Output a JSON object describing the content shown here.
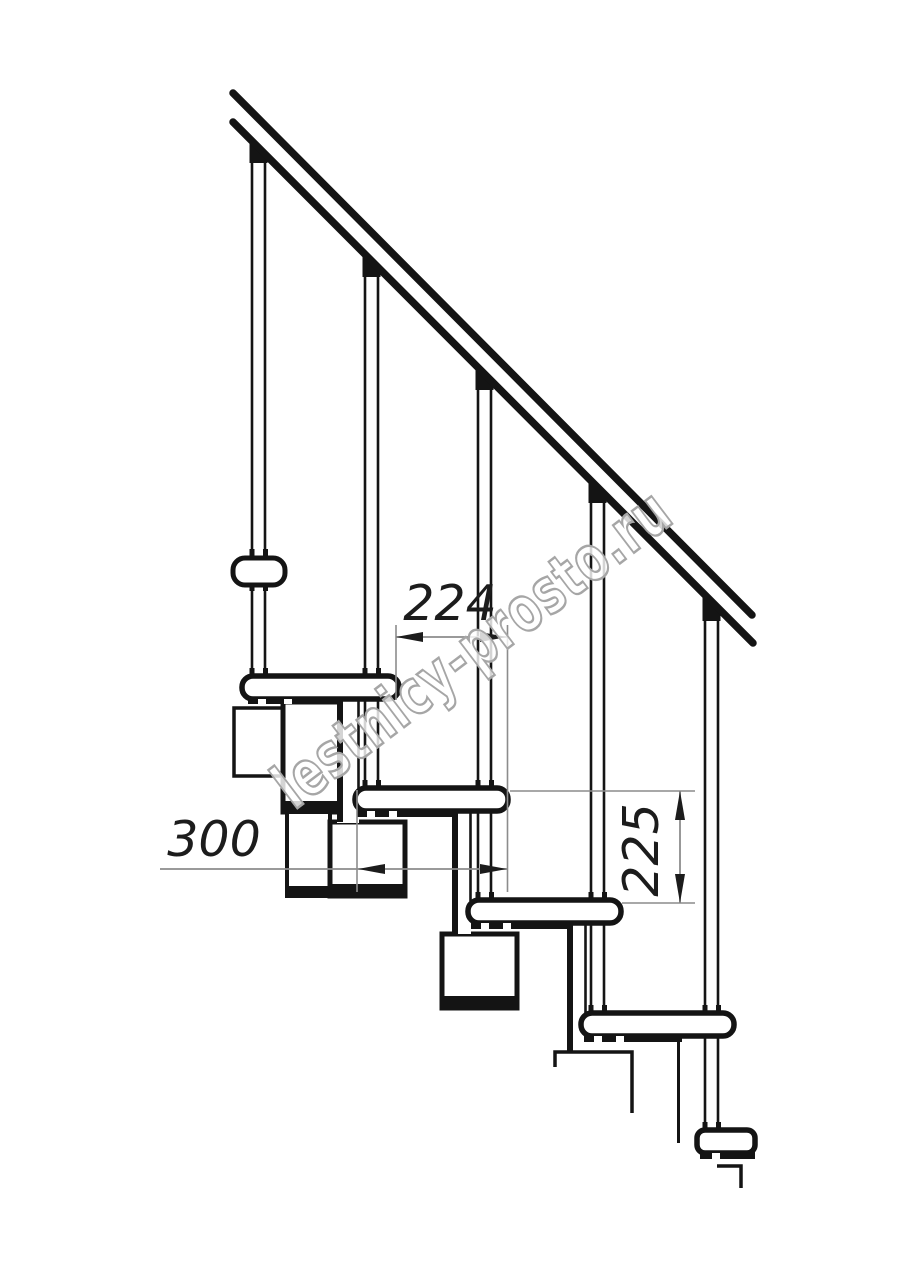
{
  "drawing": {
    "watermark": "lestnicy-prosto.ru",
    "dimensions": {
      "step_run": "224",
      "tread_depth": "300",
      "riser_height": "225"
    },
    "elements": {
      "handrail_count": 1,
      "baluster_count": 5,
      "tread_count": 5,
      "spine_module_count": 3
    },
    "colors": {
      "line": "#141414",
      "dimension_line": "#8c8c8c",
      "dimension_text": "#1c1c1c",
      "watermark_outline": "#a6a6a6",
      "background": "#ffffff"
    }
  }
}
